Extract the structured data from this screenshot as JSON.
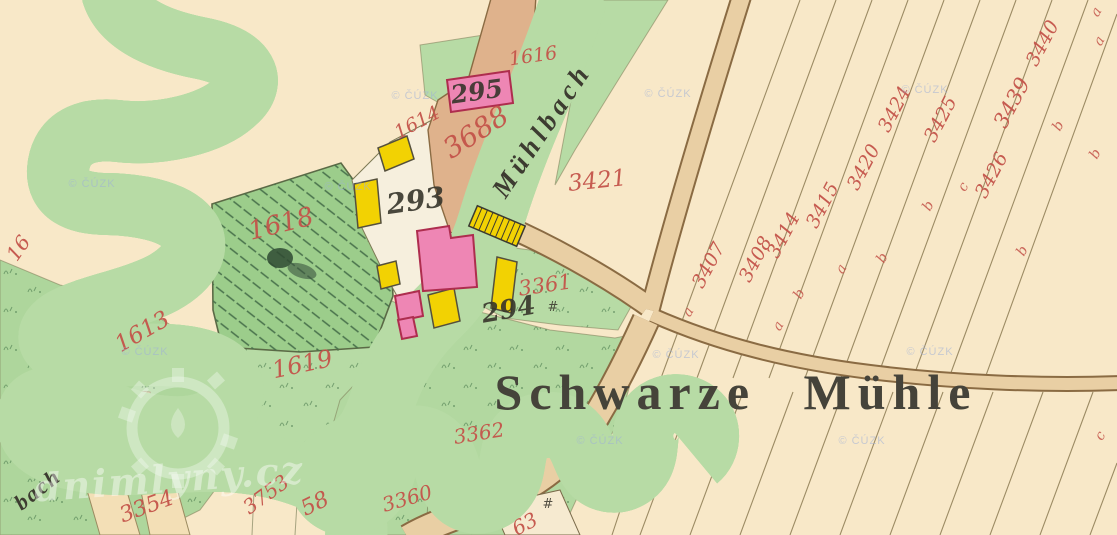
{
  "map": {
    "place_label": "Schwarze Mühle",
    "stream_label": "Mühlbach",
    "stream_label_partial": "bach",
    "watermark_text": "© ČÚZK",
    "logo_watermark_text": "dnimlyny.cz",
    "colors": {
      "background_cream": "#f8e8c8",
      "meadow_green": "#b7dba5",
      "hatched_meadow_green": "#9ccd8b",
      "water_gray": "#d5dfd7",
      "road_tan": "#e9cfa4",
      "farmyard_tan": "#dfb28c",
      "building_masonry_pink": "#ee86b4",
      "building_wood_yellow": "#f2d203",
      "parcel_number_red": "#c4544a",
      "house_number_black": "#37352b"
    },
    "parcel_numbers_red": [
      {
        "text": "1614",
        "x": 420,
        "y": 128,
        "rot": -28,
        "size": 19
      },
      {
        "text": "1616",
        "x": 534,
        "y": 62,
        "rot": -8,
        "size": 19
      },
      {
        "text": "3688",
        "x": 481,
        "y": 140,
        "rot": -33,
        "size": 28
      },
      {
        "text": "3421",
        "x": 598,
        "y": 188,
        "rot": -6,
        "size": 23
      },
      {
        "text": "1618",
        "x": 283,
        "y": 232,
        "rot": -14,
        "size": 26
      },
      {
        "text": "1613",
        "x": 146,
        "y": 338,
        "rot": -30,
        "size": 23
      },
      {
        "text": "1619",
        "x": 304,
        "y": 372,
        "rot": -12,
        "size": 24
      },
      {
        "text": "3361",
        "x": 546,
        "y": 292,
        "rot": -8,
        "size": 21
      },
      {
        "text": "3362",
        "x": 480,
        "y": 440,
        "rot": -9,
        "size": 20
      },
      {
        "text": "3360",
        "x": 409,
        "y": 505,
        "rot": -16,
        "size": 20
      },
      {
        "text": "58",
        "x": 318,
        "y": 510,
        "rot": -26,
        "size": 22
      },
      {
        "text": "3753",
        "x": 270,
        "y": 500,
        "rot": -36,
        "size": 20
      },
      {
        "text": "3354",
        "x": 149,
        "y": 513,
        "rot": -20,
        "size": 22
      },
      {
        "text": "63",
        "x": 528,
        "y": 530,
        "rot": -28,
        "size": 20
      },
      {
        "text": "3407",
        "x": 714,
        "y": 268,
        "rot": -62,
        "size": 19
      },
      {
        "text": "3408",
        "x": 761,
        "y": 262,
        "rot": -62,
        "size": 19
      },
      {
        "text": "3414",
        "x": 789,
        "y": 238,
        "rot": -62,
        "size": 19
      },
      {
        "text": "3415",
        "x": 828,
        "y": 208,
        "rot": -62,
        "size": 19
      },
      {
        "text": "3420",
        "x": 869,
        "y": 170,
        "rot": -62,
        "size": 19
      },
      {
        "text": "3424",
        "x": 900,
        "y": 112,
        "rot": -62,
        "size": 19
      },
      {
        "text": "3425",
        "x": 946,
        "y": 122,
        "rot": -62,
        "size": 19
      },
      {
        "text": "3426",
        "x": 997,
        "y": 178,
        "rot": -62,
        "size": 19
      },
      {
        "text": "3439",
        "x": 1018,
        "y": 106,
        "rot": -62,
        "size": 21
      },
      {
        "text": "3440",
        "x": 1048,
        "y": 46,
        "rot": -62,
        "size": 19
      },
      {
        "text": "16",
        "x": 24,
        "y": 252,
        "rot": -55,
        "size": 20
      }
    ],
    "classification_letters_red": [
      {
        "text": "a",
        "x": 692,
        "y": 314,
        "rot": -60
      },
      {
        "text": "a",
        "x": 782,
        "y": 328,
        "rot": -60
      },
      {
        "text": "b",
        "x": 803,
        "y": 296,
        "rot": -60
      },
      {
        "text": "a",
        "x": 845,
        "y": 271,
        "rot": -60
      },
      {
        "text": "b",
        "x": 886,
        "y": 260,
        "rot": -60
      },
      {
        "text": "b",
        "x": 932,
        "y": 208,
        "rot": -60
      },
      {
        "text": "c",
        "x": 967,
        "y": 189,
        "rot": -60
      },
      {
        "text": "b",
        "x": 1026,
        "y": 253,
        "rot": -60
      },
      {
        "text": "b",
        "x": 1062,
        "y": 128,
        "rot": -60
      },
      {
        "text": "b",
        "x": 1099,
        "y": 156,
        "rot": -60
      },
      {
        "text": "a",
        "x": 1103,
        "y": 43,
        "rot": -60
      },
      {
        "text": "a",
        "x": 1100,
        "y": 14,
        "rot": -60
      },
      {
        "text": "c",
        "x": 1104,
        "y": 438,
        "rot": -60
      }
    ],
    "house_numbers_black": [
      {
        "text": "295",
        "x": 478,
        "y": 100,
        "rot": -8,
        "size": 25
      },
      {
        "text": "293",
        "x": 417,
        "y": 210,
        "rot": -8,
        "size": 28
      },
      {
        "text": "294",
        "x": 510,
        "y": 318,
        "rot": -10,
        "size": 26
      }
    ],
    "map_symbols": [
      {
        "text": "#",
        "x": 553,
        "y": 311
      },
      {
        "text": "#",
        "x": 548,
        "y": 508
      }
    ],
    "watermarks": [
      {
        "x": 92,
        "y": 187
      },
      {
        "x": 348,
        "y": 190
      },
      {
        "x": 415,
        "y": 99
      },
      {
        "x": 668,
        "y": 97
      },
      {
        "x": 925,
        "y": 93
      },
      {
        "x": 145,
        "y": 355
      },
      {
        "x": 676,
        "y": 358
      },
      {
        "x": 930,
        "y": 355
      },
      {
        "x": 600,
        "y": 444
      },
      {
        "x": 862,
        "y": 444
      }
    ]
  }
}
